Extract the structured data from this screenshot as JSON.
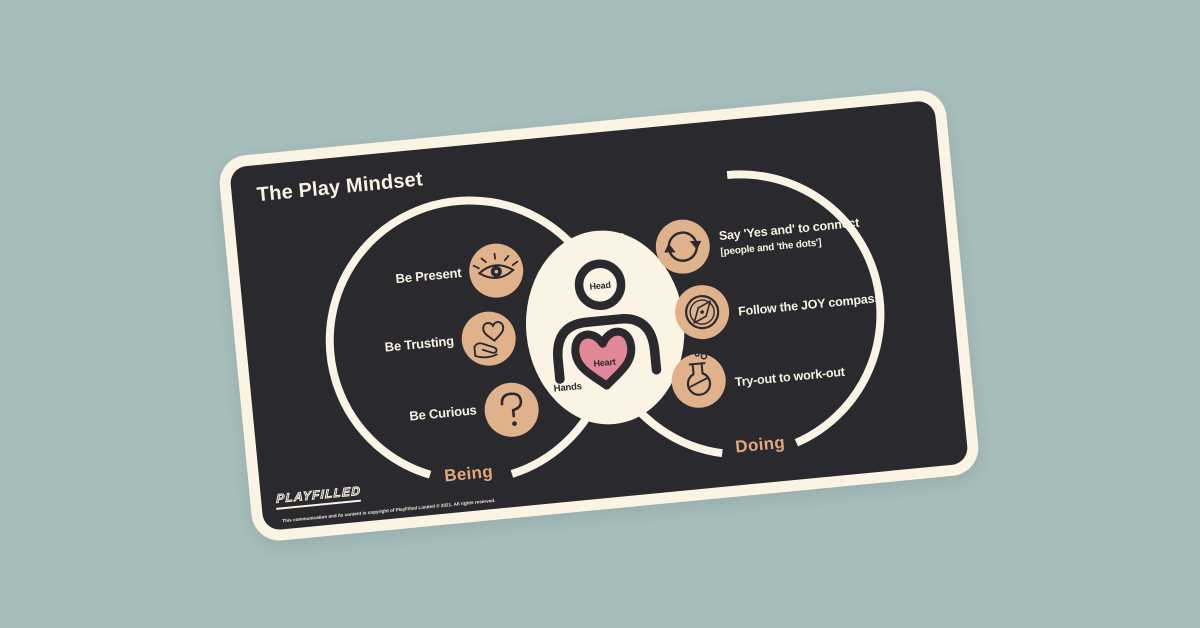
{
  "page": {
    "background_color": "#a6bdbb"
  },
  "card": {
    "title": "The Play Mindset",
    "background_color": "#2a292d",
    "border_color": "#fbf4e4",
    "being_circle": {
      "label": "Being",
      "items": [
        {
          "label": "Be Present",
          "icon": "eye-icon"
        },
        {
          "label": "Be Trusting",
          "icon": "hand-heart-icon"
        },
        {
          "label": "Be Curious",
          "icon": "question-mark-icon"
        }
      ]
    },
    "doing_circle": {
      "label": "Doing",
      "items": [
        {
          "label": "Say 'Yes and' to connect",
          "sublabel": "[people and 'the dots']",
          "icon": "cycle-arrows-icon"
        },
        {
          "label": "Follow the JOY compass",
          "icon": "compass-icon"
        },
        {
          "label": "Try-out to work-out",
          "icon": "flask-icon"
        }
      ]
    },
    "center_figure": {
      "head_label": "Head",
      "heart_label": "Heart",
      "hands_label": "Hands",
      "heart_color": "#e08798"
    },
    "footer": {
      "logo_text": "PLAYFILLED",
      "copyright": "This communication and its content is copyright of PlayFilled Limited © 2021. All rights reserved."
    },
    "colors": {
      "icon_circle": "#e0b28c",
      "venn_label": "#e4a97b",
      "cream": "#fbf4e4",
      "dark": "#2a292d"
    }
  }
}
